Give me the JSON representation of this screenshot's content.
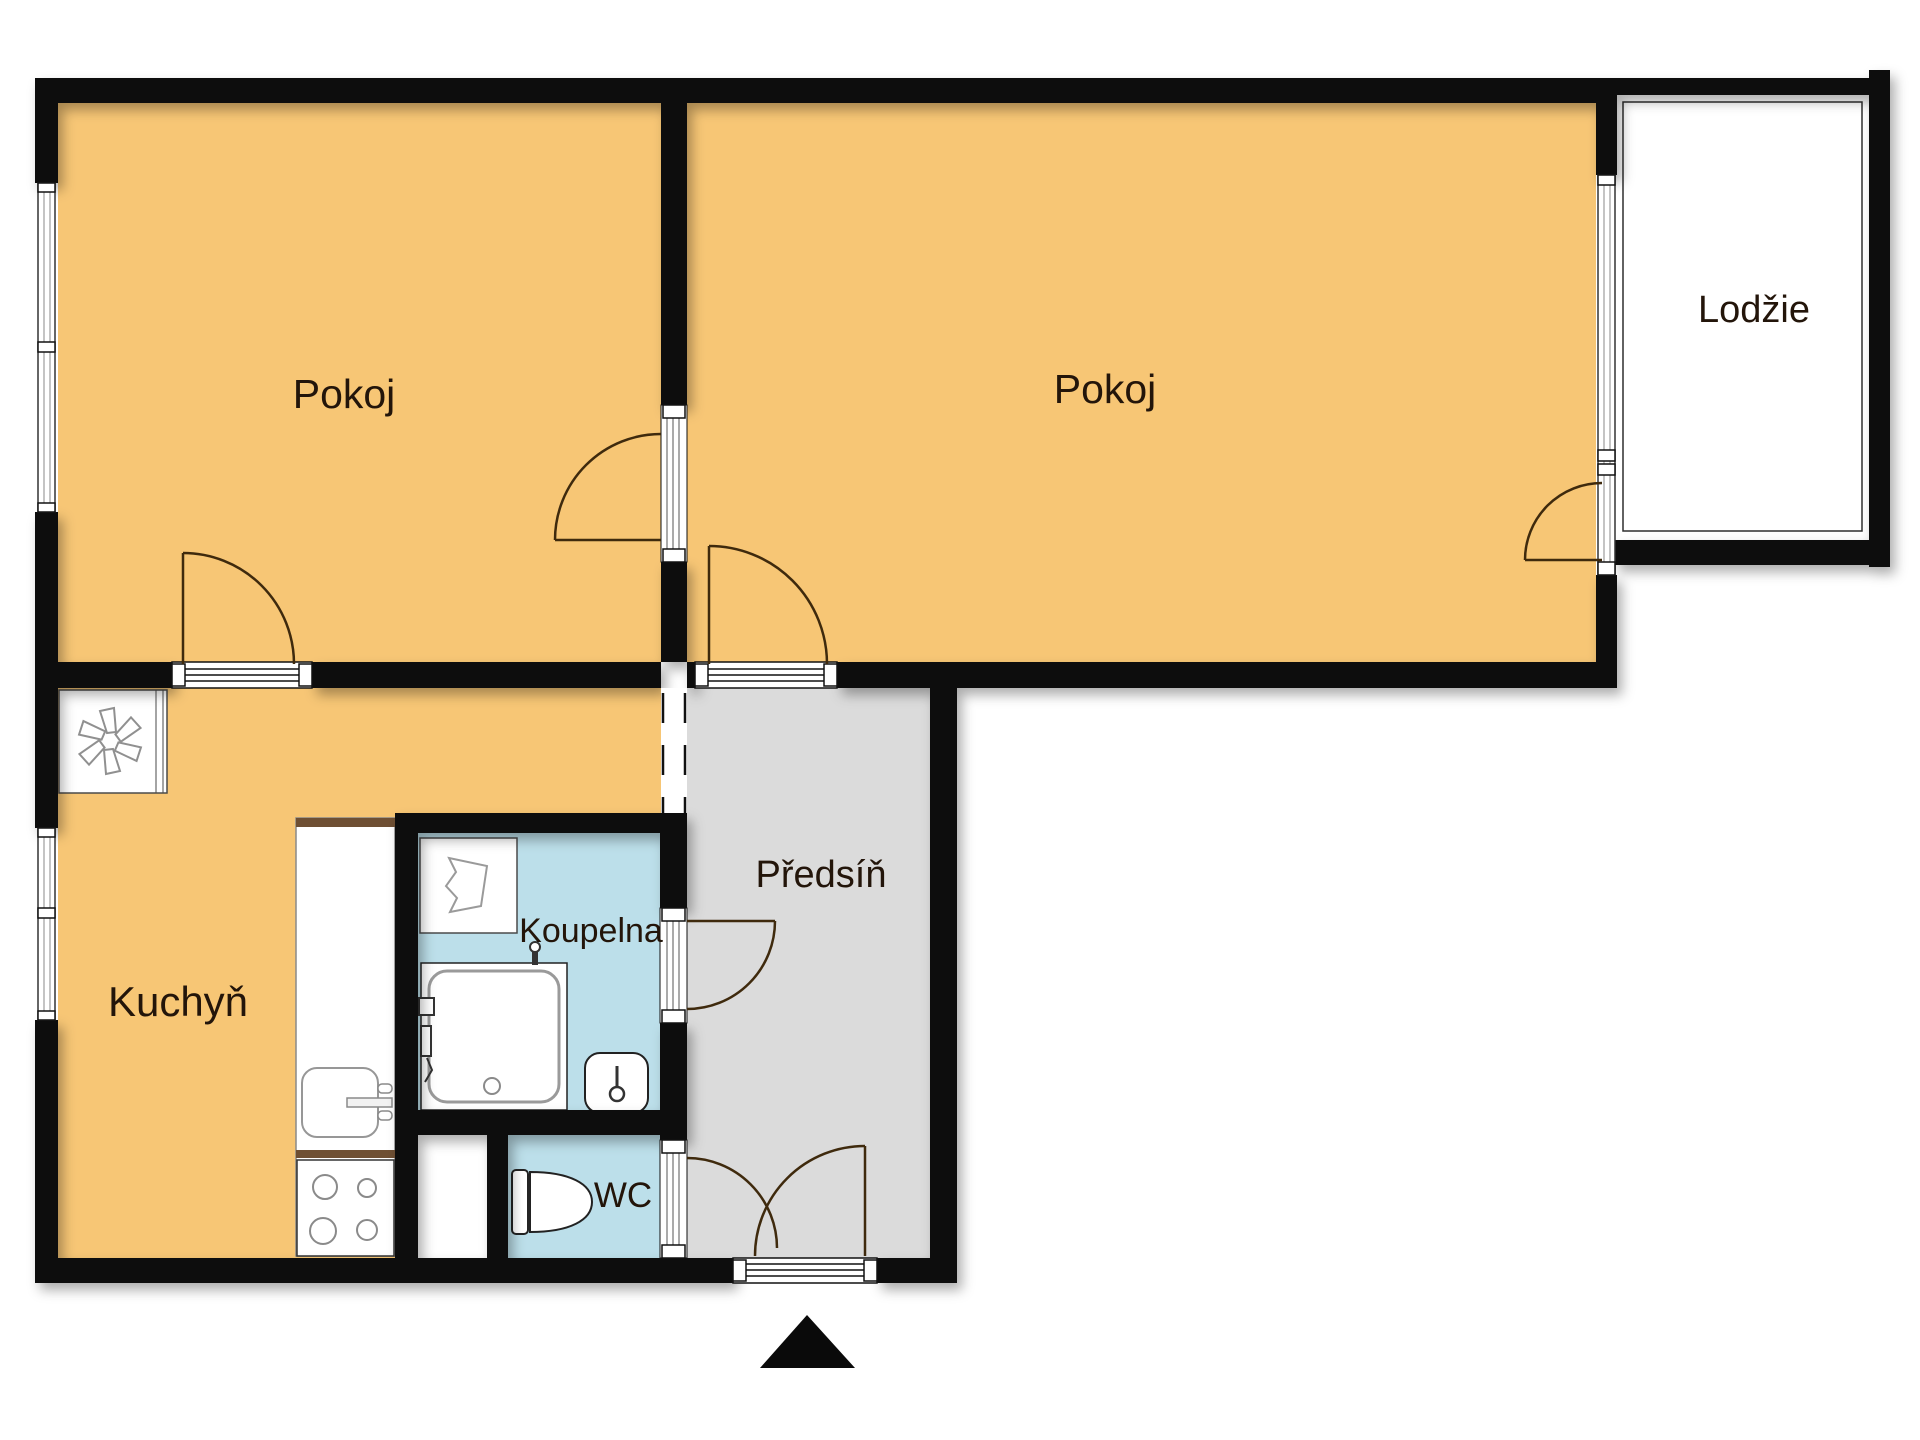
{
  "plan": {
    "type": "apartment-floor-plan",
    "language": "cs",
    "rooms": [
      {
        "id": "pokoj-1",
        "label": "Pokoj",
        "fill": "room_orange"
      },
      {
        "id": "pokoj-2",
        "label": "Pokoj",
        "fill": "room_orange"
      },
      {
        "id": "lodzie",
        "label": "Lodžie",
        "fill": "white"
      },
      {
        "id": "kuchyn",
        "label": "Kuchyň",
        "fill": "room_orange"
      },
      {
        "id": "koupelna",
        "label": "Koupelna",
        "fill": "bathroom_blue"
      },
      {
        "id": "wc",
        "label": "WC",
        "fill": "bathroom_blue"
      },
      {
        "id": "predsin",
        "label": "Předsíň",
        "fill": "hall_gray"
      }
    ],
    "colors": {
      "room_orange": "#F7C675",
      "bathroom_blue": "#BCDFEA",
      "hall_gray": "#DBDBDB",
      "wall_black": "#0A0A0A",
      "door_arc_brown": "#3F2A0D",
      "counter_brown": "#6E4F33",
      "label_color": "#23150A"
    },
    "icons": {
      "entrance-marker": "solid black triangle pointing up, below entrance door",
      "fan-symbol": "six-blade fan/impeller in white box, kitchen corner",
      "shower-tray": "square shower with drain and taps",
      "washbasin": "rounded basin with tap",
      "vanity-box": "white box with polygonal basin symbol",
      "toilet": "cistern and bowl seen from above",
      "kitchen-sink": "rounded sink bowl with wall tap",
      "stove": "four burner circles",
      "windows": "triple-line glazing strips in outer walls",
      "doors": "quarter-circle swing arcs with leaf lines"
    }
  }
}
